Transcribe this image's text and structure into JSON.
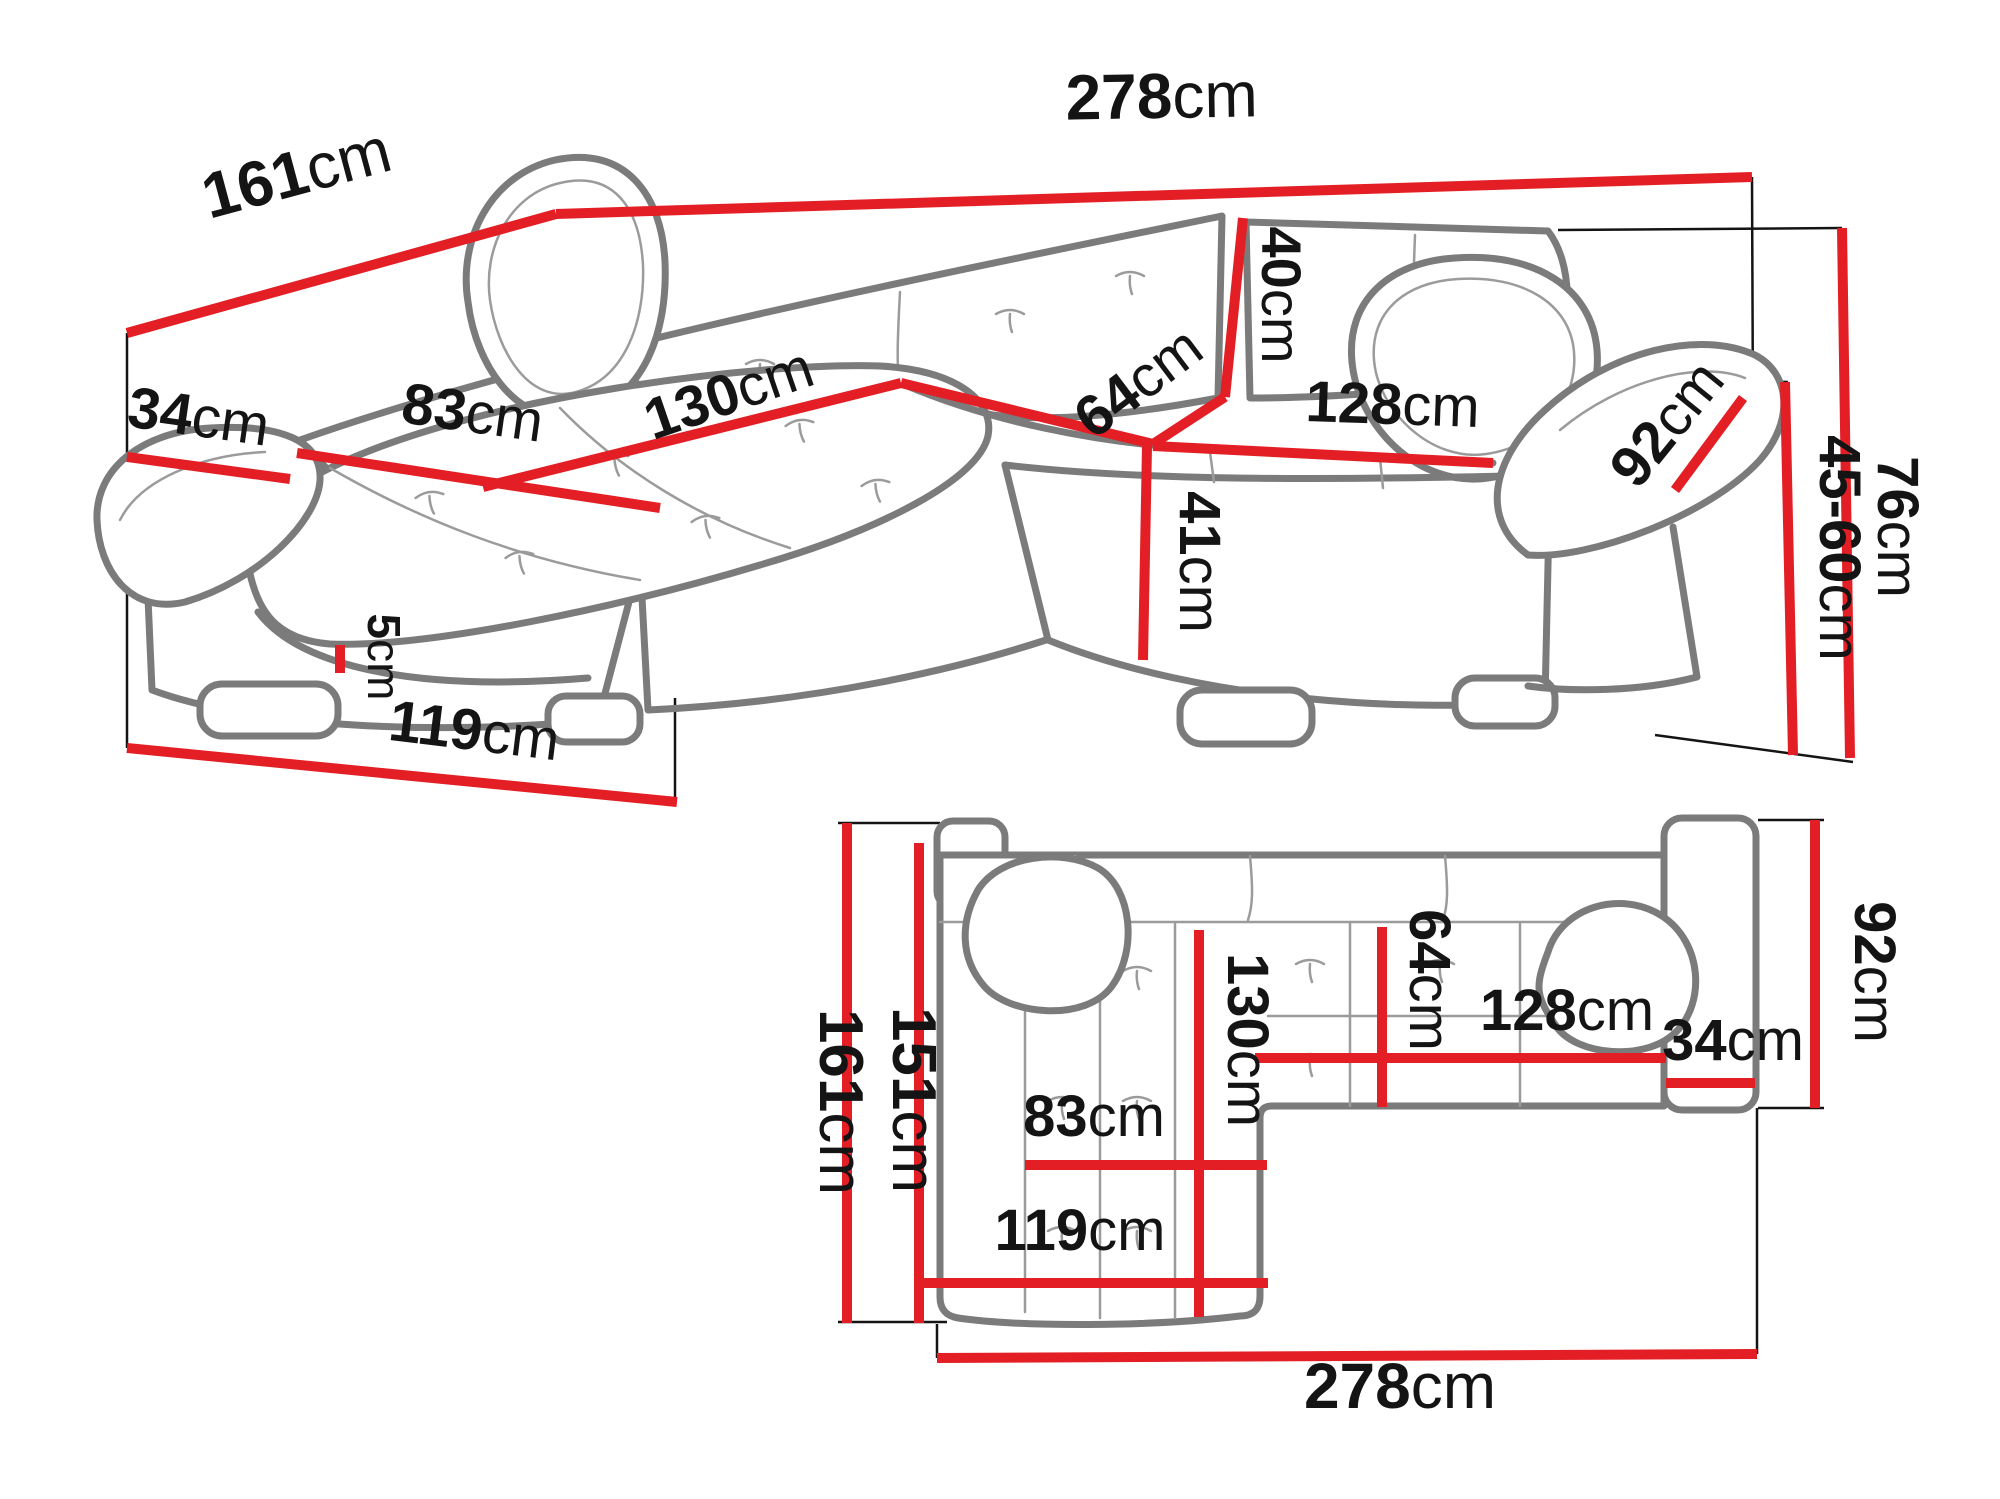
{
  "colors": {
    "dim": "#e31e24",
    "sofa": "#7b7b7b",
    "seam": "#9b9b9b",
    "ink": "#141414",
    "bg": "#ffffff"
  },
  "views": [
    {
      "name": "perspective-view",
      "labels": [
        {
          "v": "161",
          "u": "cm"
        },
        {
          "v": "278",
          "u": "cm"
        },
        {
          "v": "34",
          "u": "cm"
        },
        {
          "v": "83",
          "u": "cm"
        },
        {
          "v": "130",
          "u": "cm"
        },
        {
          "v": "64",
          "u": "cm"
        },
        {
          "v": "40",
          "u": "cm"
        },
        {
          "v": "128",
          "u": "cm"
        },
        {
          "v": "92",
          "u": "cm"
        },
        {
          "v": "41",
          "u": "cm"
        },
        {
          "v": "76",
          "u": "cm"
        },
        {
          "v": "45-60",
          "u": "cm"
        },
        {
          "v": "5",
          "u": "cm"
        },
        {
          "v": "119",
          "u": "cm"
        }
      ]
    },
    {
      "name": "plan-view",
      "labels": [
        {
          "v": "161",
          "u": "cm"
        },
        {
          "v": "151",
          "u": "cm"
        },
        {
          "v": "130",
          "u": "cm"
        },
        {
          "v": "83",
          "u": "cm"
        },
        {
          "v": "119",
          "u": "cm"
        },
        {
          "v": "278",
          "u": "cm"
        },
        {
          "v": "64",
          "u": "cm"
        },
        {
          "v": "128",
          "u": "cm"
        },
        {
          "v": "34",
          "u": "cm"
        },
        {
          "v": "92",
          "u": "cm"
        }
      ]
    }
  ]
}
